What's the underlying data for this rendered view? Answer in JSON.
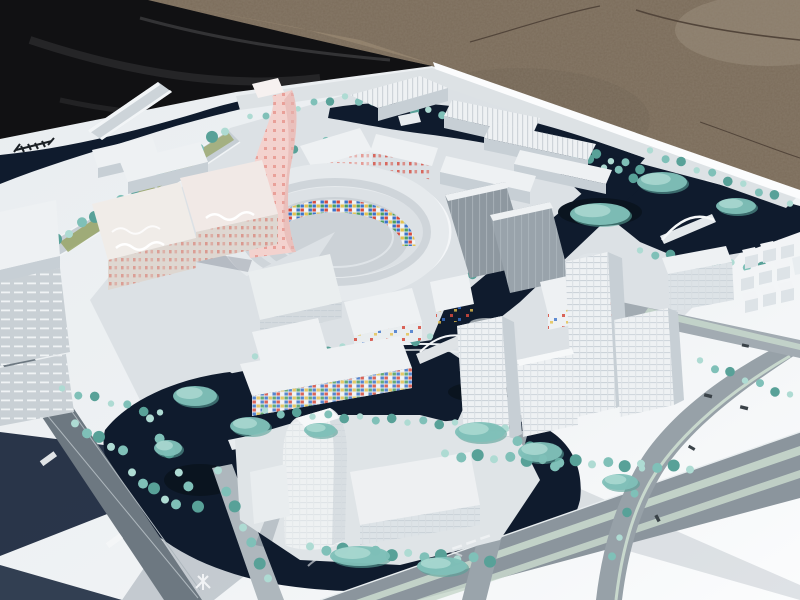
{
  "scene": {
    "subject": "Photograph of a white architectural scale model of a waterfront urban masterplan, displayed outdoors on gravel ground with a black tarp behind"
  },
  "colors": {
    "tarp": "#111113",
    "tarp_fold": "#2e2e31",
    "tarp_sheen": "#3c3c3f",
    "gravel": "#7b6c5a",
    "gravel_light": "#9b8d7b",
    "gravel_tan": "#a29077",
    "gravel_dark": "#6e6152",
    "gravel_crack": "#52453a",
    "board": "#e9edf0",
    "board_bright": "#fbfcfd",
    "board_shadow": "#18253b",
    "district": "#dce1e5",
    "water": "#0f1b2d",
    "water_deep": "#0a141f",
    "road": "#a2abb2",
    "road_dark": "#6d7881",
    "road_light": "#dde2e5",
    "road_mid": "#8b959d",
    "median_green": "#c8d8cd",
    "grass": "#98a567",
    "tree_light": "#aedbd3",
    "tree_mid": "#7fc0b8",
    "tree_dark": "#58a198",
    "building_white": "#eef1f3",
    "building_face": "#dde3e7",
    "building_shade": "#c7cfd5",
    "building_roof": "#d3d8dc",
    "building_gray": "#8e98a0",
    "building_gray2": "#99a3ab",
    "building_cream": "#f0ece8",
    "building_cream_face": "#ded7d1",
    "pink_tower": "#f3d2ce",
    "pink_dot": "#e89a94",
    "pink_shade": "#e4b4b0",
    "mosaic_red": "#d64a3c",
    "mosaic_blue": "#3a72c9",
    "mosaic_yellow": "#e4c14e",
    "mosaic_green": "#4d9e5d",
    "marking_white": "#f4f6f7",
    "rail_symbol": "#1a1f24",
    "car_dark": "#3a4248"
  },
  "trees": {
    "palette": [
      "tree_light",
      "tree_mid",
      "tree_dark"
    ],
    "back_rows": [
      {
        "x1": 30,
        "y1": 258,
        "x2": 225,
        "y2": 130,
        "n": 16,
        "r": 5
      },
      {
        "x1": 345,
        "y1": 98,
        "x2": 470,
        "y2": 118,
        "n": 10,
        "r": 4
      },
      {
        "x1": 480,
        "y1": 122,
        "x2": 640,
        "y2": 168,
        "n": 12,
        "r": 4
      },
      {
        "x1": 650,
        "y1": 152,
        "x2": 790,
        "y2": 202,
        "n": 10,
        "r": 4
      },
      {
        "x1": 560,
        "y1": 150,
        "x2": 648,
        "y2": 182,
        "n": 7,
        "r": 4
      },
      {
        "x1": 640,
        "y1": 252,
        "x2": 762,
        "y2": 268,
        "n": 9,
        "r": 4
      },
      {
        "x1": 445,
        "y1": 300,
        "x2": 500,
        "y2": 252,
        "n": 5,
        "r": 4
      },
      {
        "x1": 255,
        "y1": 358,
        "x2": 430,
        "y2": 338,
        "n": 13,
        "r": 4
      },
      {
        "x1": 250,
        "y1": 118,
        "x2": 330,
        "y2": 100,
        "n": 6,
        "r": 3.5
      },
      {
        "x1": 688,
        "y1": 262,
        "x2": 726,
        "y2": 298,
        "n": 5,
        "r": 4
      },
      {
        "x1": 262,
        "y1": 160,
        "x2": 326,
        "y2": 142,
        "n": 5,
        "r": 3.5
      }
    ],
    "front_rows": [
      {
        "x1": 265,
        "y1": 412,
        "x2": 455,
        "y2": 424,
        "n": 13,
        "r": 4
      },
      {
        "x1": 310,
        "y1": 548,
        "x2": 490,
        "y2": 560,
        "n": 12,
        "r": 5
      },
      {
        "x1": 505,
        "y1": 430,
        "x2": 555,
        "y2": 468,
        "n": 5,
        "r": 5
      },
      {
        "x1": 150,
        "y1": 420,
        "x2": 198,
        "y2": 505,
        "n": 6,
        "r": 5
      },
      {
        "x1": 445,
        "y1": 455,
        "x2": 690,
        "y2": 468,
        "n": 16,
        "r": 5
      },
      {
        "x1": 700,
        "y1": 362,
        "x2": 790,
        "y2": 396,
        "n": 7,
        "r": 4
      },
      {
        "x1": 218,
        "y1": 472,
        "x2": 268,
        "y2": 580,
        "n": 7,
        "r": 5
      },
      {
        "x1": 62,
        "y1": 390,
        "x2": 160,
        "y2": 414,
        "n": 7,
        "r": 4
      },
      {
        "x1": 75,
        "y1": 425,
        "x2": 123,
        "y2": 452,
        "n": 5,
        "r": 5
      },
      {
        "x1": 132,
        "y1": 474,
        "x2": 176,
        "y2": 506,
        "n": 5,
        "r": 5
      },
      {
        "x1": 642,
        "y1": 470,
        "x2": 612,
        "y2": 558,
        "n": 5,
        "r": 4
      }
    ],
    "clusters": [
      {
        "cx": 195,
        "cy": 396,
        "rx": 22,
        "ry": 10
      },
      {
        "cx": 250,
        "cy": 426,
        "rx": 20,
        "ry": 9
      },
      {
        "cx": 480,
        "cy": 432,
        "rx": 25,
        "ry": 10
      },
      {
        "cx": 540,
        "cy": 452,
        "rx": 22,
        "ry": 10
      },
      {
        "cx": 620,
        "cy": 482,
        "rx": 18,
        "ry": 8
      },
      {
        "cx": 360,
        "cy": 556,
        "rx": 30,
        "ry": 10
      },
      {
        "cx": 442,
        "cy": 566,
        "rx": 25,
        "ry": 9
      },
      {
        "cx": 662,
        "cy": 182,
        "rx": 25,
        "ry": 10
      },
      {
        "cx": 736,
        "cy": 206,
        "rx": 20,
        "ry": 8
      },
      {
        "cx": 600,
        "cy": 214,
        "rx": 30,
        "ry": 11
      },
      {
        "cx": 320,
        "cy": 430,
        "rx": 16,
        "ry": 7
      },
      {
        "cx": 168,
        "cy": 448,
        "rx": 14,
        "ry": 8
      }
    ]
  }
}
